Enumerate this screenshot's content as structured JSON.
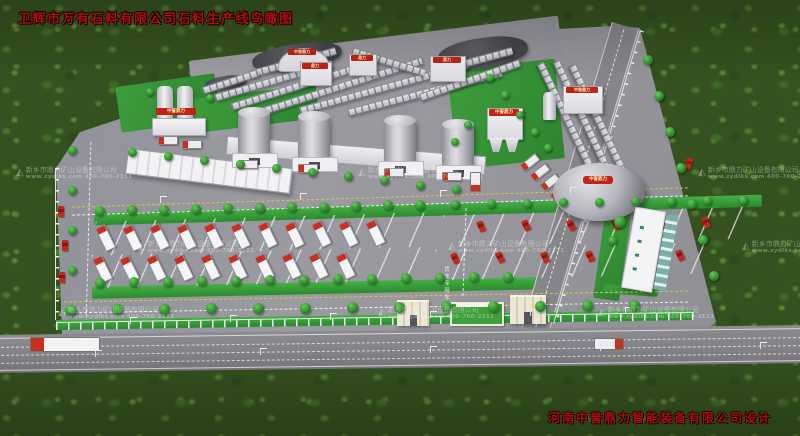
{
  "scene": {
    "title": "卫辉市万有石料有限公司石料生产线鸟瞰图",
    "designer_credit": "河南中誉鼎力智能装备有限公司设计"
  },
  "watermark": {
    "logo_glyph": "◭",
    "company": "新乡市鼎力矿山设备有限公司",
    "website": "www.zydlks.com",
    "phone": "400-700-2111"
  },
  "signs": {
    "brand_short": "鼎力",
    "brand_full": "中誉鼎力"
  },
  "road_markings": {
    "truck_lane_text": "货车专用车道"
  },
  "colors": {
    "title_red": "#a31212",
    "sign_red": "#c02418",
    "forest_green": "#34511f",
    "lawn_green": "#3da03d",
    "yard_gray": "#93939a",
    "truck_red": "#c5301f"
  }
}
